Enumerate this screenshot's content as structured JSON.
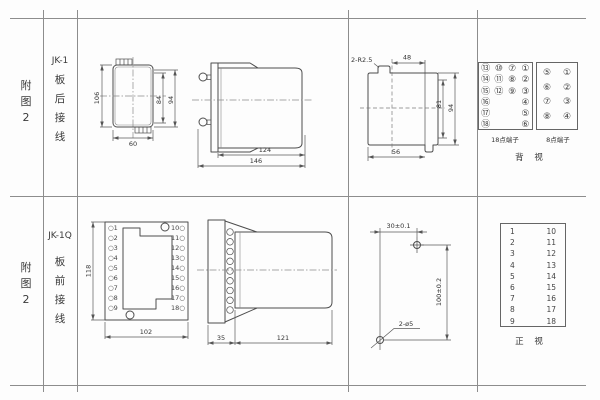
{
  "row_top": {
    "fig": "附\n图\n2",
    "model": "JK-1",
    "wiring": "板\n后\n接\n线",
    "front": {
      "h": "106",
      "inner": "84",
      "outer": "94",
      "w": "60"
    },
    "side": {
      "body": "124",
      "total": "146"
    },
    "cutout": {
      "note": "2-R2.5",
      "top": "48",
      "inner": "81",
      "outer": "94",
      "bottom": "56"
    },
    "t18": {
      "label": "18点端子",
      "col1": "⑬\n⑭\n⑮\n⑯\n⑰\n⑱",
      "col2": "⑩\n⑪\n⑫",
      "col3": "⑦\n⑧\n⑨",
      "col4": "①\n②\n③\n④\n⑤\n⑥"
    },
    "t8": {
      "label": "8点端子",
      "col1": "⑤\n⑥\n⑦\n⑧",
      "col2": "①\n②\n③\n④"
    },
    "view": "背 视"
  },
  "row_bottom": {
    "fig": "附\n图\n2",
    "model": "JK-1Q",
    "wiring": "板\n前\n接\n线",
    "front": {
      "h": "118",
      "w": "102",
      "left_terms": "○1\n○2\n○3\n○4\n○5\n○6\n○7\n○8\n○9",
      "right_terms": "10○\n11○\n12○\n13○\n14○\n15○\n16○\n17○\n18○"
    },
    "side": {
      "plate": "35",
      "body": "121"
    },
    "drill": {
      "w": "30±0.1",
      "h": "100±0.2",
      "note": "2-ø5"
    },
    "table": {
      "left": "1\n2\n3\n4\n5\n6\n7\n8\n9",
      "right": "10\n11\n12\n13\n14\n15\n16\n17\n18"
    },
    "view": "正 视"
  }
}
